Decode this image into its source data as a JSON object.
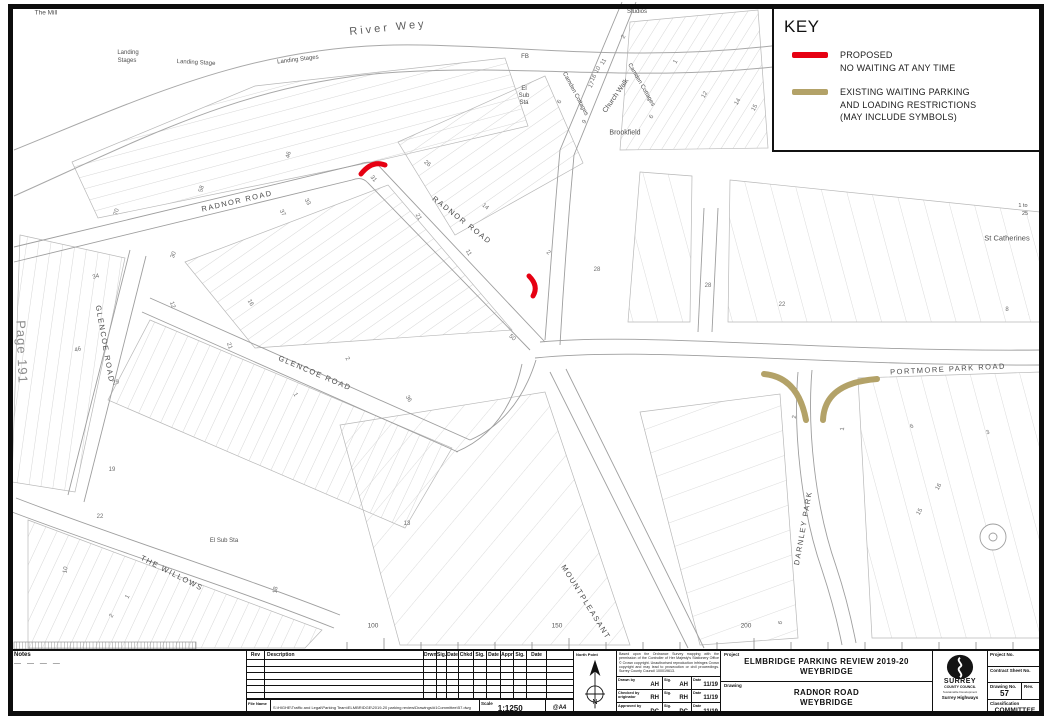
{
  "key": {
    "title": "KEY",
    "proposed": {
      "line1": "PROPOSED",
      "line2": "NO WAITING AT ANY TIME",
      "color": "#e60012"
    },
    "existing": {
      "line1": "EXISTING WAITING PARKING",
      "line2": "AND LOADING RESTRICTIONS",
      "line3": "(MAY INCLUDE SYMBOLS)",
      "color": "#b3a268"
    }
  },
  "map": {
    "labels": [
      {
        "t": "The Mill",
        "x": 46,
        "y": 13,
        "fs": 6.5,
        "name": "label-the-mill"
      },
      {
        "t": "River Wey",
        "x": 388,
        "y": 28,
        "r": -6,
        "fs": 11,
        "cls": "river",
        "name": "label-river-wey"
      },
      {
        "t": "Landing",
        "x": 128,
        "y": 53,
        "fs": 6,
        "name": "label-landing-stages"
      },
      {
        "t": "Stages",
        "x": 127,
        "y": 61,
        "fs": 6,
        "name": "label-landing-stages"
      },
      {
        "t": "Landing Stage",
        "x": 196,
        "y": 63,
        "r": 3,
        "fs": 6,
        "name": "label-landing-stage"
      },
      {
        "t": "Landing Stages",
        "x": 298,
        "y": 60,
        "r": -7,
        "fs": 6,
        "name": "label-landing-stages"
      },
      {
        "t": "Studios",
        "x": 637,
        "y": 12,
        "fs": 6,
        "name": "label-studios"
      },
      {
        "t": "FB",
        "x": 525,
        "y": 57,
        "fs": 6,
        "name": "label-fb"
      },
      {
        "t": "El",
        "x": 524,
        "y": 89,
        "fs": 6,
        "name": "label-el-sub-sta"
      },
      {
        "t": "Sub",
        "x": 524,
        "y": 96,
        "fs": 6,
        "name": "label-el-sub-sta"
      },
      {
        "t": "Sta",
        "x": 524,
        "y": 103,
        "fs": 6,
        "name": "label-el-sub-sta"
      },
      {
        "t": "Camden Cottages",
        "x": 575,
        "y": 94,
        "r": 62,
        "fs": 6,
        "name": "label-camden-cottages"
      },
      {
        "t": "Church Walk",
        "x": 616,
        "y": 96,
        "r": -55,
        "fs": 7,
        "name": "label-church-walk"
      },
      {
        "t": "Camden Cottages",
        "x": 641,
        "y": 85,
        "r": 60,
        "fs": 6,
        "name": "label-camden-cottages"
      },
      {
        "t": "Brookfield",
        "x": 625,
        "y": 133,
        "fs": 7,
        "name": "label-brookfield"
      },
      {
        "t": "RADNOR ROAD",
        "x": 237,
        "y": 201,
        "r": -13,
        "fs": 7.5,
        "cls": "road",
        "name": "label-radnor-road"
      },
      {
        "t": "RADNOR ROAD",
        "x": 462,
        "y": 220,
        "r": 38,
        "fs": 7.5,
        "cls": "road",
        "name": "label-radnor-road"
      },
      {
        "t": "GLENCOE ROAD",
        "x": 105,
        "y": 344,
        "r": 80,
        "fs": 7.5,
        "cls": "road",
        "name": "label-glencoe-road"
      },
      {
        "t": "GLENCOE ROAD",
        "x": 315,
        "y": 373,
        "r": 23,
        "fs": 7.5,
        "cls": "road",
        "name": "label-glencoe-road"
      },
      {
        "t": "PORTMORE PARK ROAD",
        "x": 948,
        "y": 369,
        "r": -3,
        "fs": 7.5,
        "cls": "road",
        "name": "label-portmore-park-road"
      },
      {
        "t": "St Catherines",
        "x": 1007,
        "y": 238,
        "fs": 7.5,
        "name": "label-st-catherines"
      },
      {
        "t": "1 to",
        "x": 1023,
        "y": 206,
        "fs": 5.5,
        "name": "label-house-range"
      },
      {
        "t": "25",
        "x": 1025,
        "y": 214,
        "fs": 5.5,
        "name": "label-house-range"
      },
      {
        "t": "DARNLEY PARK",
        "x": 803,
        "y": 528,
        "r": -80,
        "fs": 7.5,
        "cls": "road",
        "name": "label-darnley-park"
      },
      {
        "t": "MOUNTPLEASANT",
        "x": 586,
        "y": 602,
        "r": 58,
        "fs": 7.5,
        "cls": "road",
        "name": "label-mountpleasant"
      },
      {
        "t": "THE WILLOWS",
        "x": 172,
        "y": 573,
        "r": 27,
        "fs": 7.5,
        "cls": "road",
        "name": "label-the-willows"
      },
      {
        "t": "El Sub Sta",
        "x": 224,
        "y": 541,
        "fs": 6,
        "name": "label-el-sub-sta"
      },
      {
        "t": "Page 191",
        "x": 22,
        "y": 352,
        "r": 88,
        "fs": 13,
        "cls": "page-ref",
        "name": "page-reference"
      }
    ],
    "house_numbers": [
      {
        "t": "58",
        "x": 202,
        "y": 189,
        "r": -75
      },
      {
        "t": "46",
        "x": 289,
        "y": 155,
        "r": -75
      },
      {
        "t": "70",
        "x": 117,
        "y": 212,
        "r": -75
      },
      {
        "t": "30",
        "x": 174,
        "y": 255,
        "r": -70
      },
      {
        "t": "16",
        "x": 250,
        "y": 303,
        "r": 60
      },
      {
        "t": "26",
        "x": 427,
        "y": 164,
        "r": 40
      },
      {
        "t": "14",
        "x": 485,
        "y": 207,
        "r": 40
      },
      {
        "t": "2",
        "x": 548,
        "y": 253,
        "r": 40
      },
      {
        "t": "31",
        "x": 373,
        "y": 179,
        "r": 50
      },
      {
        "t": "33",
        "x": 307,
        "y": 202,
        "r": 60
      },
      {
        "t": "37",
        "x": 282,
        "y": 213,
        "r": 60
      },
      {
        "t": "21",
        "x": 418,
        "y": 217,
        "r": 60
      },
      {
        "t": "11",
        "x": 468,
        "y": 253,
        "r": 60
      },
      {
        "t": "50",
        "x": 512,
        "y": 338,
        "r": 40
      },
      {
        "t": "34",
        "x": 96,
        "y": 277,
        "r": -15
      },
      {
        "t": "46",
        "x": 78,
        "y": 350,
        "r": -15
      },
      {
        "t": "29",
        "x": 116,
        "y": 383,
        "r": -15
      },
      {
        "t": "12",
        "x": 172,
        "y": 305,
        "r": 70
      },
      {
        "t": "21",
        "x": 229,
        "y": 346,
        "r": 70
      },
      {
        "t": "2",
        "x": 347,
        "y": 359,
        "r": 60
      },
      {
        "t": "1",
        "x": 295,
        "y": 395,
        "r": 60
      },
      {
        "t": "36",
        "x": 408,
        "y": 399,
        "r": 60
      },
      {
        "t": "22",
        "x": 100,
        "y": 517
      },
      {
        "t": "19",
        "x": 112,
        "y": 470
      },
      {
        "t": "10",
        "x": 66,
        "y": 570,
        "r": -80
      },
      {
        "t": "13",
        "x": 407,
        "y": 524
      },
      {
        "t": "1",
        "x": 128,
        "y": 597,
        "r": -60
      },
      {
        "t": "2",
        "x": 112,
        "y": 616,
        "r": -60
      },
      {
        "t": "18",
        "x": 276,
        "y": 590,
        "r": -80
      },
      {
        "t": "2",
        "x": 624,
        "y": 37,
        "r": -60
      },
      {
        "t": "11",
        "x": 604,
        "y": 62,
        "r": -60
      },
      {
        "t": "10",
        "x": 598,
        "y": 70,
        "r": -60
      },
      {
        "t": "16",
        "x": 594,
        "y": 78,
        "r": -60
      },
      {
        "t": "17",
        "x": 592,
        "y": 85,
        "r": -60
      },
      {
        "t": "6",
        "x": 560,
        "y": 102,
        "r": -60
      },
      {
        "t": "9",
        "x": 585,
        "y": 122,
        "r": -60
      },
      {
        "t": "1",
        "x": 676,
        "y": 62,
        "r": -60
      },
      {
        "t": "12",
        "x": 705,
        "y": 95,
        "r": -60
      },
      {
        "t": "14",
        "x": 738,
        "y": 102,
        "r": -60
      },
      {
        "t": "15",
        "x": 755,
        "y": 108,
        "r": -60
      },
      {
        "t": "6",
        "x": 652,
        "y": 117,
        "r": -60
      },
      {
        "t": "28",
        "x": 597,
        "y": 270
      },
      {
        "t": "28",
        "x": 708,
        "y": 286
      },
      {
        "t": "22",
        "x": 782,
        "y": 305
      },
      {
        "t": "16",
        "x": 939,
        "y": 487,
        "r": -60
      },
      {
        "t": "15",
        "x": 920,
        "y": 512,
        "r": -60
      },
      {
        "t": "6",
        "x": 781,
        "y": 623,
        "r": -70
      },
      {
        "t": "2",
        "x": 795,
        "y": 417,
        "r": -85
      },
      {
        "t": "1",
        "x": 843,
        "y": 429,
        "r": -85
      },
      {
        "t": "6",
        "x": 912,
        "y": 427,
        "r": -20
      },
      {
        "t": "3",
        "x": 988,
        "y": 433,
        "r": -20
      },
      {
        "t": "8",
        "x": 1007,
        "y": 310
      }
    ],
    "scale_labels": [
      {
        "t": "100",
        "x": 373,
        "y": 626
      },
      {
        "t": "150",
        "x": 557,
        "y": 626
      },
      {
        "t": "200",
        "x": 746,
        "y": 626
      }
    ]
  },
  "titleblock": {
    "notes_label": "Notes",
    "notes_dashes": "— — — —",
    "revision_table": {
      "headers": [
        "Rev",
        "Description",
        "Drwn",
        "Sig.",
        "Date",
        "Chkd",
        "Sig.",
        "Date",
        "Appr",
        "Sig.",
        "Date"
      ],
      "empty_rows": 6
    },
    "file_name_label": "File Name",
    "file_name": "S:\\HIGHE\\Traffic and Legal\\Parking Team\\ELMBRIDGE\\2019-20 parking review\\Drawings\\#1Committee\\57.dwg",
    "scale_label": "Scale",
    "scale": "1:1250",
    "paper": "@A4",
    "north_label": "North Point",
    "copyright": "Based upon the Ordnance Survey mapping with the permission of the Controller of Her Majesty's Stationery Office © Crown copyright. Unauthorised reproduction infringes Crown copyright and may lead to prosecution or civil proceedings. Surrey County Council 100019613.",
    "signoff": [
      {
        "label": "Drawn by",
        "initials": "AH",
        "sig_label": "Sig.",
        "sig": "AH",
        "date_label": "Date",
        "date": "11/19"
      },
      {
        "label": "Checked by originator",
        "initials": "RH",
        "sig_label": "Sig.",
        "sig": "RH",
        "date_label": "Date",
        "date": "11/19"
      },
      {
        "label": "Approved by",
        "initials": "DC",
        "sig_label": "Sig.",
        "sig": "DC",
        "date_label": "Date",
        "date": "11/19"
      }
    ],
    "project_label": "Project",
    "project_line1": "ELMBRIDGE PARKING REVIEW 2019-20",
    "project_line2": "WEYBRIDGE",
    "drawing_label": "Drawing",
    "drawing_line1": "RADNOR ROAD",
    "drawing_line2": "WEYBRIDGE",
    "sheet_label": "SHEET",
    "of_label": "OF",
    "org": {
      "name1": "SURREY",
      "name2": "COUNTY COUNCIL",
      "tagline": "Sustainable Development",
      "dept": "Surrey Highways"
    },
    "refs": {
      "project_no_label": "Project No.",
      "contract_label": "Contract Sheet No.",
      "drawing_no_label": "Drawing No.",
      "drawing_no": "57",
      "rev_label": "Rev.",
      "class_label": "Classification",
      "status": "COMMITTEE"
    }
  }
}
